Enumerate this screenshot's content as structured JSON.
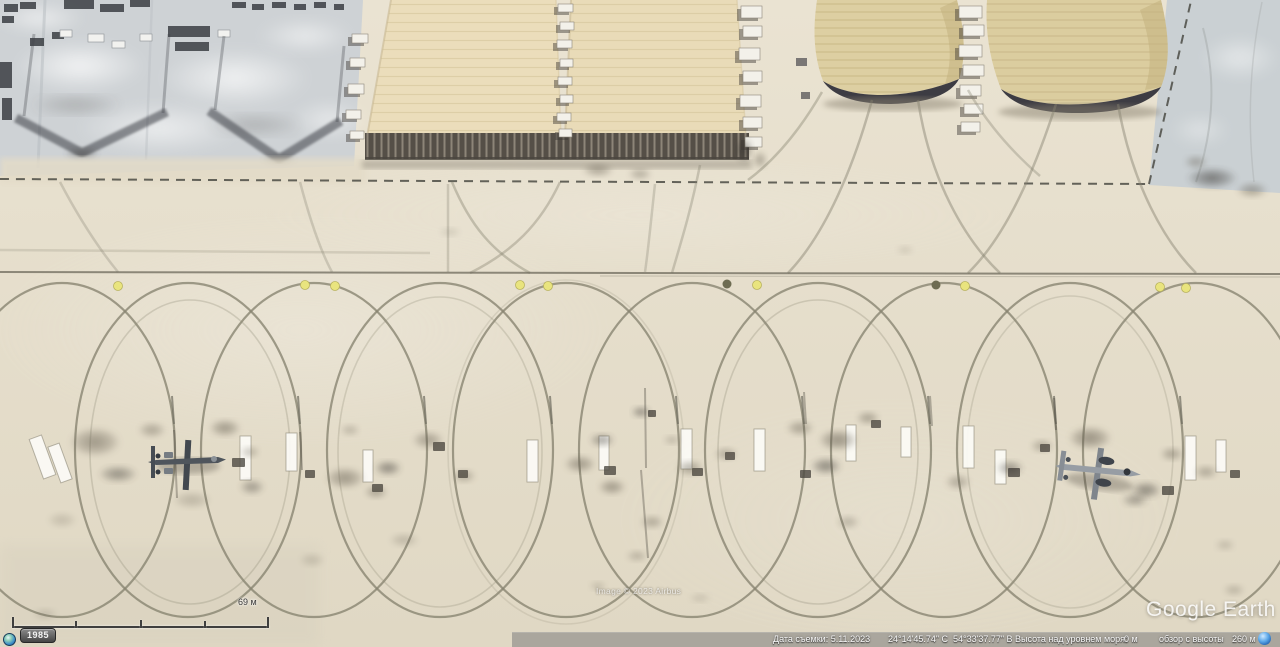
{
  "app": {
    "title": "Google Earth"
  },
  "map": {
    "attribution": "Image © 2023 Airbus",
    "watermark": "Google Earth"
  },
  "scale_bar": {
    "label": "69 м"
  },
  "time_slider": {
    "year_badge": "1985"
  },
  "status_bar": {
    "imagery_date": "Дата съемки: 5.11.2023",
    "latitude": "24°14'45.74\" С",
    "longitude": "54°33'37.77\" В",
    "elevation_label": "Высота над уровнем моря:",
    "elevation_value": "0 м",
    "eye_altitude_label": "обзор с высоты",
    "eye_altitude_value": "260 м"
  },
  "icons": {
    "historical": "clock-icon",
    "streaming": "globe-icon"
  },
  "colors": {
    "apron": "#e6dfcc",
    "concrete_gray": "#ced2d5",
    "hangar_cream": "#ebddbb",
    "hangar_tan": "#ddcfa2",
    "hangar_opening": "#3d3c43",
    "marking_yellow": "#e9e47e",
    "taxi_line": "#7f7c70",
    "status_bar_bg": "rgba(125,125,125,0.55)"
  }
}
